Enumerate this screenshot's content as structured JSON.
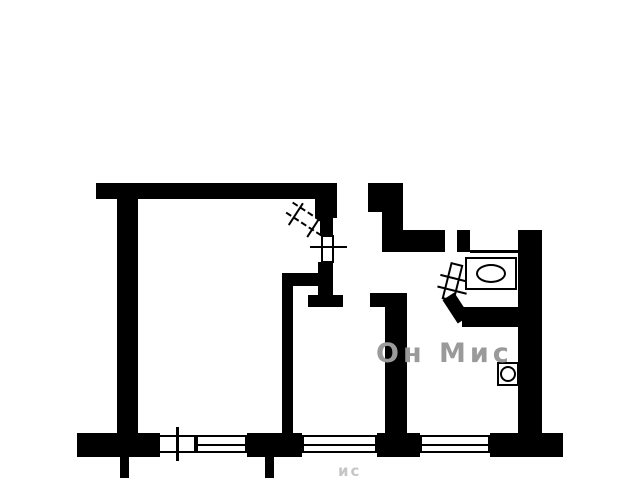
{
  "meta": {
    "background_color": "#ffffff",
    "wall_color": "#000000",
    "watermark_color": "#9a9a9a",
    "watermark_fragment_color": "#c6c6c6"
  },
  "watermark": {
    "text": "Он Мис",
    "fragment": "ис"
  },
  "floorplan": {
    "shapes": [
      {
        "name": "top-wall",
        "x": 96,
        "y": 183,
        "w": 241,
        "h": 16
      },
      {
        "name": "left-wall",
        "x": 117,
        "y": 198,
        "w": 21,
        "h": 236
      },
      {
        "name": "entry-wall-block",
        "x": 368,
        "y": 183,
        "w": 35,
        "h": 29
      },
      {
        "name": "entry-wall-stem",
        "x": 382,
        "y": 211,
        "w": 21,
        "h": 21
      },
      {
        "name": "bathroom-top-wall",
        "x": 382,
        "y": 230,
        "w": 63,
        "h": 22
      },
      {
        "name": "bathroom-top-jamb",
        "x": 457,
        "y": 230,
        "w": 13,
        "h": 22
      },
      {
        "name": "bathroom-top-edge-line",
        "x": 470,
        "y": 250,
        "w": 48,
        "h": 3
      },
      {
        "name": "right-wall",
        "x": 518,
        "y": 230,
        "w": 24,
        "h": 206
      },
      {
        "name": "bathroom-bottom-wall",
        "x": 462,
        "y": 307,
        "w": 58,
        "h": 20
      },
      {
        "name": "kitchen-wall-flare",
        "x": 370,
        "y": 293,
        "w": 37,
        "h": 14
      },
      {
        "name": "kitchen-wall",
        "x": 385,
        "y": 293,
        "w": 22,
        "h": 141
      },
      {
        "name": "hallway-wall-upper",
        "x": 315,
        "y": 193,
        "w": 22,
        "h": 25
      },
      {
        "name": "hallway-wall-mid",
        "x": 320,
        "y": 218,
        "w": 13,
        "h": 18
      },
      {
        "name": "hallway-vent-box",
        "x": 321,
        "y": 235,
        "w": 13,
        "h": 28,
        "fill": "#ffffff",
        "border": 2
      },
      {
        "name": "hallway-vent-tick",
        "x": 310,
        "y": 246,
        "w": 37,
        "h": 2
      },
      {
        "name": "hallway-wall-lower",
        "x": 318,
        "y": 262,
        "w": 15,
        "h": 24
      },
      {
        "name": "hallway-stub-wall",
        "x": 282,
        "y": 273,
        "w": 51,
        "h": 13
      },
      {
        "name": "hallway-foot-stem",
        "x": 318,
        "y": 286,
        "w": 15,
        "h": 11
      },
      {
        "name": "hallway-foot-wall",
        "x": 308,
        "y": 295,
        "w": 35,
        "h": 12
      },
      {
        "name": "room-divider-wall",
        "x": 282,
        "y": 286,
        "w": 11,
        "h": 148
      },
      {
        "name": "bottom-wall-1",
        "x": 77,
        "y": 433,
        "w": 83,
        "h": 24
      },
      {
        "name": "bottom-wall-2",
        "x": 247,
        "y": 433,
        "w": 55,
        "h": 24
      },
      {
        "name": "bottom-wall-3",
        "x": 377,
        "y": 433,
        "w": 43,
        "h": 24
      },
      {
        "name": "bottom-wall-4",
        "x": 490,
        "y": 433,
        "w": 73,
        "h": 24
      },
      {
        "name": "balcony-stub-left",
        "x": 120,
        "y": 457,
        "w": 9,
        "h": 21
      },
      {
        "name": "balcony-stub-mid",
        "x": 265,
        "y": 457,
        "w": 9,
        "h": 21
      },
      {
        "name": "window-1",
        "x": 158,
        "y": 435,
        "w": 38,
        "h": 18,
        "fill": "#ffffff",
        "border": 2
      },
      {
        "name": "window-1-tick",
        "x": 176,
        "y": 427,
        "w": 3,
        "h": 34
      },
      {
        "name": "window-2",
        "x": 196,
        "y": 435,
        "w": 51,
        "h": 18,
        "fill": "#ffffff",
        "border": 2,
        "children": [
          {
            "name": "window-2-mullion",
            "x": 0,
            "y": 7,
            "w": 47,
            "h": 2
          }
        ]
      },
      {
        "name": "window-3",
        "x": 302,
        "y": 435,
        "w": 75,
        "h": 18,
        "fill": "#ffffff",
        "border": 2,
        "children": [
          {
            "name": "window-3-mullion",
            "x": 0,
            "y": 7,
            "w": 71,
            "h": 2
          }
        ]
      },
      {
        "name": "window-4",
        "x": 420,
        "y": 435,
        "w": 70,
        "h": 18,
        "fill": "#ffffff",
        "border": 2,
        "children": [
          {
            "name": "window-4-mullion",
            "x": 0,
            "y": 7,
            "w": 66,
            "h": 2
          }
        ]
      },
      {
        "name": "entry-door-leaf",
        "x": 286,
        "y": 212,
        "w": 42,
        "h": 14,
        "rot": 33,
        "fill": "none",
        "dash": true,
        "children": [
          {
            "name": "entry-door-tick-1",
            "x": 8,
            "y": -6,
            "w": 2,
            "h": 26
          },
          {
            "name": "entry-door-tick-2",
            "x": 30,
            "y": -6,
            "w": 2,
            "h": 26
          }
        ]
      },
      {
        "name": "bathroom-door-leaf",
        "x": 446,
        "y": 263,
        "w": 13,
        "h": 38,
        "rot": 14,
        "fill": "#ffffff",
        "border": 2,
        "children": [
          {
            "name": "bathroom-door-tick-1",
            "x": -9,
            "y": 12,
            "w": 30,
            "h": 2
          },
          {
            "name": "bathroom-door-tick-2",
            "x": -9,
            "y": 24,
            "w": 30,
            "h": 2
          }
        ]
      },
      {
        "name": "bathroom-door-jamb",
        "x": 449,
        "y": 294,
        "w": 14,
        "h": 28,
        "rot": -33
      },
      {
        "name": "bathtub",
        "x": 465,
        "y": 257,
        "w": 52,
        "h": 33,
        "fill": "#ffffff",
        "border": 2,
        "children": [
          {
            "name": "bathtub-basin",
            "x": 9,
            "y": 5,
            "w": 30,
            "h": 19,
            "fill": "none",
            "border": 2,
            "radius": "50%"
          }
        ]
      },
      {
        "name": "kitchen-sink",
        "x": 497,
        "y": 362,
        "w": 22,
        "h": 24,
        "fill": "#ffffff",
        "border": 2,
        "children": [
          {
            "name": "kitchen-sink-bowl",
            "x": 1,
            "y": 2,
            "w": 16,
            "h": 16,
            "fill": "none",
            "border": 2,
            "radius": "50%"
          }
        ]
      }
    ]
  }
}
